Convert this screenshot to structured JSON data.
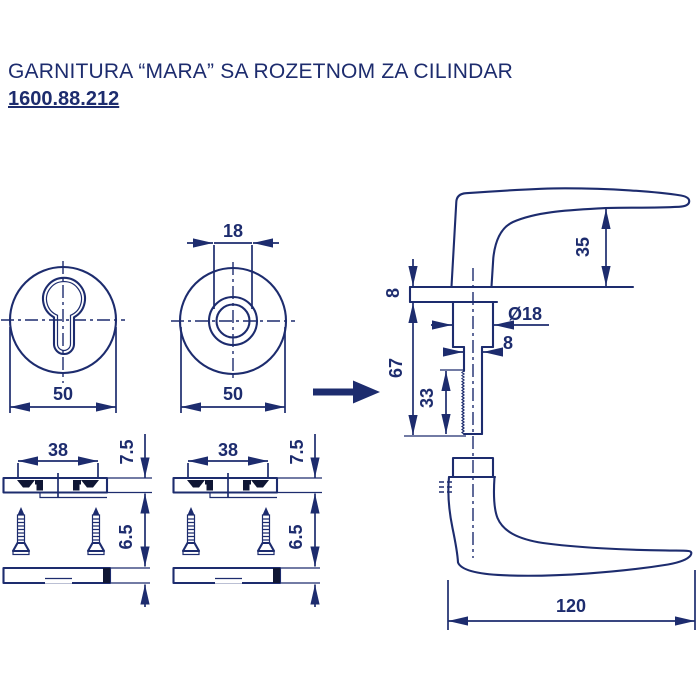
{
  "header": {
    "title": "GARNITURA “MARA” SA ROZETNOM ZA CILINDAR",
    "code": "1600.88.212"
  },
  "colors": {
    "line": "#1d2c6e",
    "dark_fill": "#0f1634",
    "background": "#ffffff"
  },
  "views": {
    "rosette_cylinder_front": {
      "diameter": "50"
    },
    "rosette_hole_front": {
      "diameter": "50",
      "hole_diameter": "18"
    },
    "base_side_left": {
      "hole_spacing": "38",
      "thickness": "7.5",
      "cover_thickness": "6.5"
    },
    "base_side_right": {
      "hole_spacing": "38",
      "thickness": "7.5",
      "cover_thickness": "6.5"
    },
    "handle_side": {
      "grip_offset": "35",
      "rosette_thickness": "8",
      "neck_diameter": "Ø18",
      "spindle_width": "8",
      "stem_length": "67",
      "spline_length": "33",
      "handle_length": "120"
    }
  }
}
